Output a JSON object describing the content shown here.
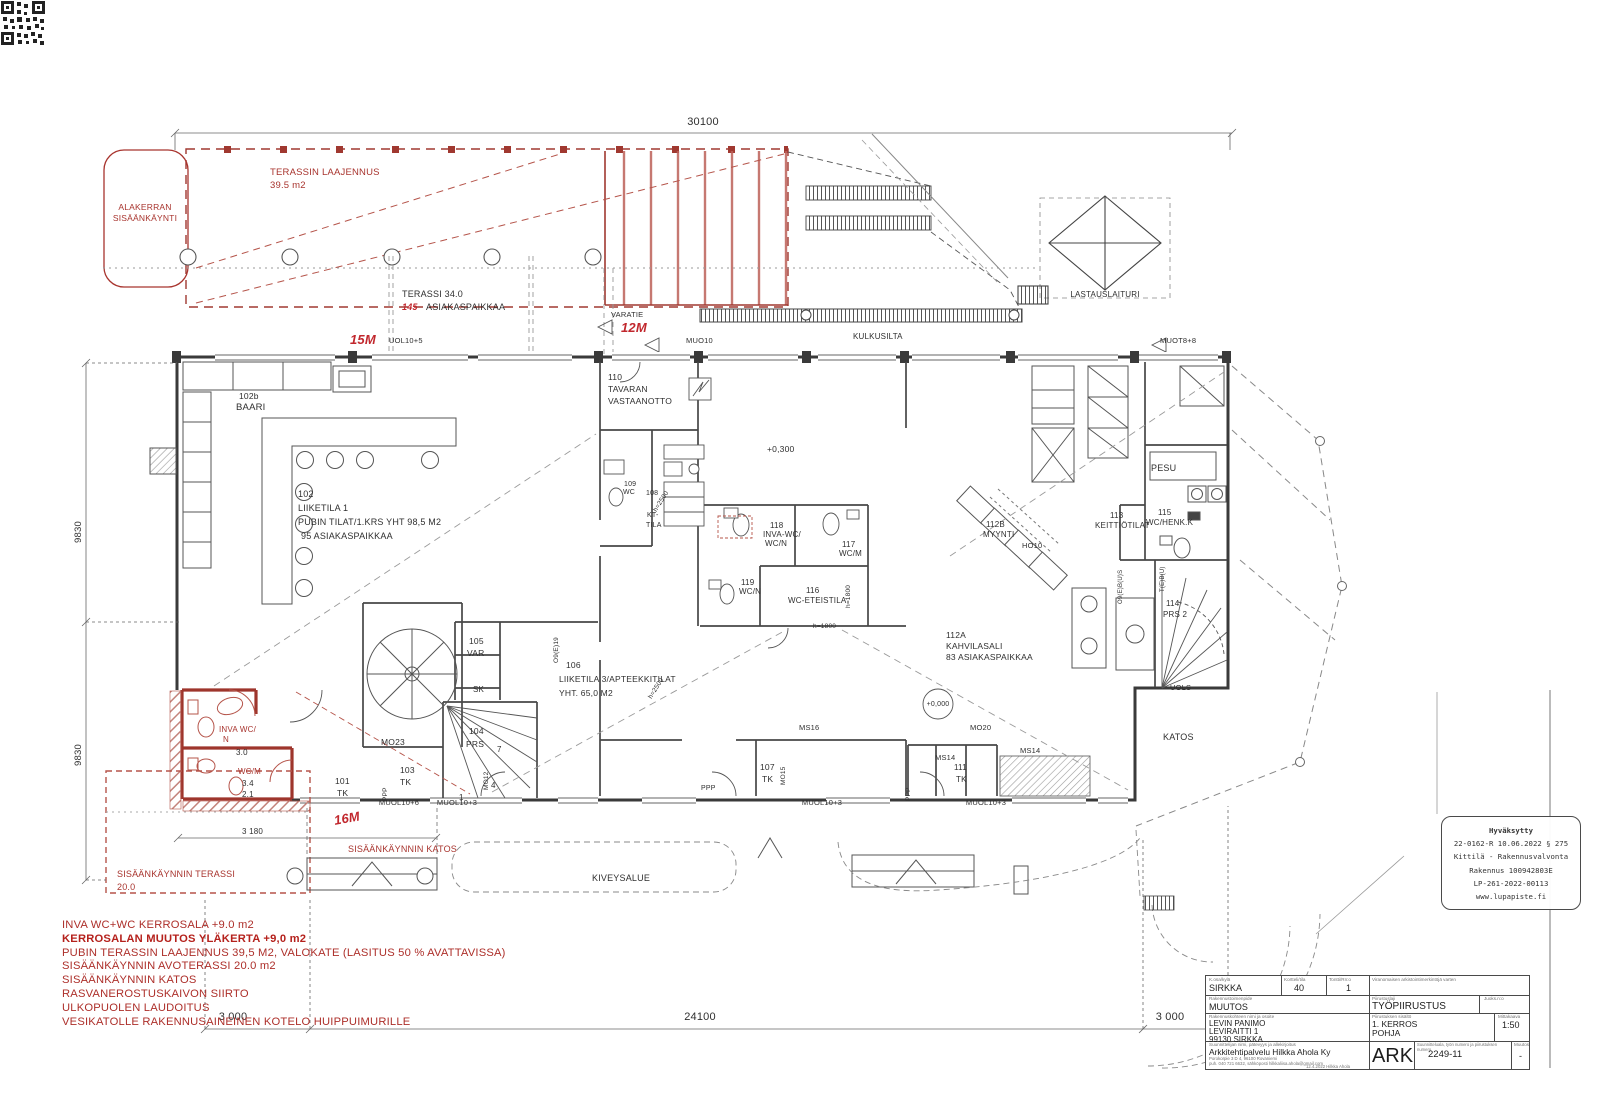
{
  "drawing": {
    "type": "architectural-floor-plan",
    "accent_red": "#a8342e",
    "ink": "#3a3a3a"
  },
  "labels": [
    {
      "t": "30100",
      "x": 703,
      "y": 117,
      "s": 11,
      "m": 1
    },
    {
      "t": "TERASSIN LAAJENNUS",
      "x": 270,
      "y": 168,
      "c": "r",
      "s": 9.5
    },
    {
      "t": "39.5 m2",
      "x": 270,
      "y": 181,
      "c": "r",
      "s": 9.5
    },
    {
      "t": "ALAKERRAN",
      "x": 145,
      "y": 203,
      "c": "r",
      "s": 8.5,
      "m": 1
    },
    {
      "t": "SISÄÄNKÄYNTI",
      "x": 145,
      "y": 214,
      "c": "r",
      "s": 8.5,
      "m": 1
    },
    {
      "t": "TERASSI 34.0",
      "x": 402,
      "y": 290,
      "s": 9
    },
    {
      "t": "145",
      "x": 402,
      "y": 303,
      "c": "rb",
      "s": 9
    },
    {
      "t": "ASIAKASPAIKKAA",
      "x": 426,
      "y": 303,
      "s": 9
    },
    {
      "t": "15M",
      "x": 350,
      "y": 333,
      "c": "rb",
      "s": 13
    },
    {
      "t": "UOL10+5",
      "x": 389,
      "y": 337,
      "s": 7.5
    },
    {
      "t": "VARATIE",
      "x": 611,
      "y": 311,
      "s": 7.5
    },
    {
      "t": "12M",
      "x": 621,
      "y": 321,
      "c": "rb",
      "s": 13
    },
    {
      "t": "MUO10",
      "x": 686,
      "y": 337,
      "s": 7.5
    },
    {
      "t": "KULKUSILTA",
      "x": 853,
      "y": 333,
      "s": 8
    },
    {
      "t": "MUOT8+8",
      "x": 1160,
      "y": 337,
      "s": 7.5
    },
    {
      "t": "LASTAUSLAITURI",
      "x": 1105,
      "y": 291,
      "s": 8,
      "m": 1
    },
    {
      "t": "102b",
      "x": 239,
      "y": 392,
      "s": 8.5
    },
    {
      "t": "BAARI",
      "x": 236,
      "y": 403,
      "s": 9.5
    },
    {
      "t": "110",
      "x": 608,
      "y": 373,
      "s": 8.5
    },
    {
      "t": "TAVARAN",
      "x": 608,
      "y": 385,
      "s": 8.5
    },
    {
      "t": "VASTAANOTTO",
      "x": 608,
      "y": 397,
      "s": 8.5
    },
    {
      "t": "102",
      "x": 298,
      "y": 490,
      "s": 9
    },
    {
      "t": "LIIKETILA 1",
      "x": 298,
      "y": 504,
      "s": 9
    },
    {
      "t": "PUBIN TILAT/1.KRS YHT 98,5 M2",
      "x": 298,
      "y": 518,
      "s": 9
    },
    {
      "t": "95 ASIAKASPAIKKAA",
      "x": 301,
      "y": 532,
      "s": 9
    },
    {
      "t": "109",
      "x": 624,
      "y": 481,
      "s": 7
    },
    {
      "t": "WC",
      "x": 623,
      "y": 489,
      "s": 7
    },
    {
      "t": "108",
      "x": 646,
      "y": 490,
      "s": 7
    },
    {
      "t": "KT-",
      "x": 647,
      "y": 512,
      "s": 7
    },
    {
      "t": "TILA",
      "x": 646,
      "y": 522,
      "s": 7
    },
    {
      "t": "h=2500",
      "x": 653,
      "y": 510,
      "s": 6.5,
      "r": -58
    },
    {
      "t": "+0,300",
      "x": 767,
      "y": 445,
      "s": 8.5
    },
    {
      "t": "118",
      "x": 770,
      "y": 522,
      "s": 8
    },
    {
      "t": "INVA-WC/",
      "x": 763,
      "y": 531,
      "s": 8
    },
    {
      "t": "WC/N",
      "x": 765,
      "y": 540,
      "s": 8
    },
    {
      "t": "117",
      "x": 842,
      "y": 541,
      "s": 8
    },
    {
      "t": "WC/M",
      "x": 839,
      "y": 550,
      "s": 8
    },
    {
      "t": "119",
      "x": 741,
      "y": 579,
      "s": 8
    },
    {
      "t": "WC/N",
      "x": 739,
      "y": 588,
      "s": 8
    },
    {
      "t": "116",
      "x": 806,
      "y": 587,
      "s": 8
    },
    {
      "t": "WC-ETEISTILA",
      "x": 788,
      "y": 597,
      "s": 8
    },
    {
      "t": "112B",
      "x": 986,
      "y": 521,
      "s": 8
    },
    {
      "t": "MYYNTI",
      "x": 983,
      "y": 531,
      "s": 8
    },
    {
      "t": "113",
      "x": 1110,
      "y": 512,
      "s": 8
    },
    {
      "t": "KEITTIÖTILAT",
      "x": 1095,
      "y": 522,
      "s": 8
    },
    {
      "t": "PESU",
      "x": 1151,
      "y": 464,
      "s": 9
    },
    {
      "t": "115",
      "x": 1158,
      "y": 509,
      "s": 8
    },
    {
      "t": "WC/HENK.K",
      "x": 1146,
      "y": 519,
      "s": 8
    },
    {
      "t": "HO10",
      "x": 1022,
      "y": 542,
      "s": 7.5
    },
    {
      "t": "112A",
      "x": 946,
      "y": 631,
      "s": 8.5
    },
    {
      "t": "KAHVILASALI",
      "x": 946,
      "y": 642,
      "s": 8.5
    },
    {
      "t": "83 ASIAKASPAIKKAA",
      "x": 946,
      "y": 653,
      "s": 8.5
    },
    {
      "t": "+0,000",
      "x": 938,
      "y": 701,
      "s": 7,
      "m": 1
    },
    {
      "t": "106",
      "x": 566,
      "y": 661,
      "s": 8.5
    },
    {
      "t": "LIIKETILA 3/APTEEKKITILAT",
      "x": 559,
      "y": 675,
      "s": 8.5
    },
    {
      "t": "YHT. 65,0 M2",
      "x": 559,
      "y": 689,
      "s": 8.5
    },
    {
      "t": "105",
      "x": 469,
      "y": 637,
      "s": 8.5
    },
    {
      "t": "VAR",
      "x": 467,
      "y": 649,
      "s": 8.5
    },
    {
      "t": "SK",
      "x": 473,
      "y": 686,
      "s": 8
    },
    {
      "t": "104",
      "x": 469,
      "y": 727,
      "s": 8.5
    },
    {
      "t": "PRS",
      "x": 466,
      "y": 740,
      "s": 8.5
    },
    {
      "t": "7",
      "x": 497,
      "y": 746,
      "s": 8
    },
    {
      "t": "4",
      "x": 491,
      "y": 782,
      "s": 8
    },
    {
      "t": "1",
      "x": 459,
      "y": 794,
      "s": 8
    },
    {
      "t": "MO12",
      "x": 484,
      "y": 790,
      "s": 6.5,
      "r": -90
    },
    {
      "t": "MO23",
      "x": 381,
      "y": 738,
      "s": 8.5
    },
    {
      "t": "103",
      "x": 400,
      "y": 766,
      "s": 8.5
    },
    {
      "t": "TK",
      "x": 400,
      "y": 778,
      "s": 8.5
    },
    {
      "t": "101",
      "x": 335,
      "y": 777,
      "s": 8.5
    },
    {
      "t": "TK",
      "x": 337,
      "y": 789,
      "s": 8.5
    },
    {
      "t": "PPP",
      "x": 383,
      "y": 801,
      "s": 6.5,
      "r": -90
    },
    {
      "t": "O9(E)19",
      "x": 554,
      "y": 663,
      "s": 6.5,
      "r": -90
    },
    {
      "t": "h=1800",
      "x": 846,
      "y": 608,
      "s": 6.5,
      "r": -90
    },
    {
      "t": "h=1800",
      "x": 813,
      "y": 624,
      "s": 6.5
    },
    {
      "t": "h=2500",
      "x": 648,
      "y": 697,
      "s": 6.5,
      "r": -58
    },
    {
      "t": "MS16",
      "x": 799,
      "y": 724,
      "s": 7.5
    },
    {
      "t": "MO15",
      "x": 781,
      "y": 785,
      "s": 6.5,
      "r": -90
    },
    {
      "t": "107",
      "x": 760,
      "y": 763,
      "s": 8.5
    },
    {
      "t": "TK",
      "x": 762,
      "y": 775,
      "s": 8.5
    },
    {
      "t": "PPP",
      "x": 701,
      "y": 785,
      "s": 7
    },
    {
      "t": "PPP",
      "x": 906,
      "y": 801,
      "s": 6.5,
      "r": -90
    },
    {
      "t": "MO20",
      "x": 970,
      "y": 724,
      "s": 7.5
    },
    {
      "t": "MS14",
      "x": 935,
      "y": 754,
      "s": 7.5
    },
    {
      "t": "111",
      "x": 954,
      "y": 764,
      "s": 8
    },
    {
      "t": "TK",
      "x": 956,
      "y": 776,
      "s": 8
    },
    {
      "t": "MS14",
      "x": 1020,
      "y": 747,
      "s": 7.5
    },
    {
      "t": "114",
      "x": 1166,
      "y": 600,
      "s": 8
    },
    {
      "t": "PRS 2",
      "x": 1163,
      "y": 611,
      "s": 8
    },
    {
      "t": "O9(E)B(U)S",
      "x": 1118,
      "y": 604,
      "s": 6,
      "r": -90
    },
    {
      "t": "T(E)B(U)",
      "x": 1160,
      "y": 592,
      "s": 6,
      "r": -90
    },
    {
      "t": "UOLS",
      "x": 1170,
      "y": 684,
      "s": 7.5
    },
    {
      "t": "KATOS",
      "x": 1163,
      "y": 733,
      "s": 9
    },
    {
      "t": "INVA WC/",
      "x": 219,
      "y": 726,
      "c": "r",
      "s": 8
    },
    {
      "t": "N",
      "x": 223,
      "y": 736,
      "c": "r",
      "s": 8
    },
    {
      "t": "3.0",
      "x": 236,
      "y": 749,
      "s": 8
    },
    {
      "t": "WC/M",
      "x": 238,
      "y": 768,
      "c": "r",
      "s": 8
    },
    {
      "t": "3.4",
      "x": 242,
      "y": 780,
      "s": 8
    },
    {
      "t": "2.1",
      "x": 242,
      "y": 791,
      "s": 8
    },
    {
      "t": "16M",
      "x": 333,
      "y": 814,
      "c": "rb",
      "s": 13,
      "r": -10
    },
    {
      "t": "MUOL10+6",
      "x": 399,
      "y": 799,
      "s": 7.5,
      "m": 1
    },
    {
      "t": "MUOL10+3",
      "x": 457,
      "y": 799,
      "s": 7.5,
      "m": 1
    },
    {
      "t": "MUOL10+3",
      "x": 822,
      "y": 799,
      "s": 7.5,
      "m": 1
    },
    {
      "t": "MUOL10+3",
      "x": 986,
      "y": 799,
      "s": 7.5,
      "m": 1
    },
    {
      "t": "SISÄÄNKÄYNNIN KATOS",
      "x": 348,
      "y": 845,
      "c": "r",
      "s": 9
    },
    {
      "t": "3 180",
      "x": 242,
      "y": 828,
      "s": 8
    },
    {
      "t": "SISÄÄNKÄYNNIN TERASSI",
      "x": 117,
      "y": 870,
      "c": "r",
      "s": 9
    },
    {
      "t": "20.0",
      "x": 117,
      "y": 883,
      "c": "r",
      "s": 9
    },
    {
      "t": "KIVEYSALUE",
      "x": 592,
      "y": 874,
      "s": 9
    },
    {
      "t": "9830",
      "x": 74,
      "y": 543,
      "s": 9.5,
      "r": -90
    },
    {
      "t": "9830",
      "x": 74,
      "y": 766,
      "s": 9.5,
      "r": -90
    },
    {
      "t": "3 000",
      "x": 233,
      "y": 1012,
      "s": 11,
      "m": 1
    },
    {
      "t": "24100",
      "x": 700,
      "y": 1012,
      "s": 11,
      "m": 1
    },
    {
      "t": "3 000",
      "x": 1170,
      "y": 1012,
      "s": 11,
      "m": 1
    }
  ],
  "notes": {
    "lines": [
      {
        "t": "INVA WC+WC KERROSALA +9.0 m2"
      },
      {
        "t": "KERROSALAN MUUTOS YLÄKERTA +9,0 m2",
        "b": 1
      },
      {
        "t": "PUBIN TERASSIN LAAJENNUS 39,5 M2, VALOKATE (LASITUS 50 % AVATTAVISSA)"
      },
      {
        "t": "SISÄÄNKÄYNNIN AVOTERASSI 20.0 m2"
      },
      {
        "t": "SISÄÄNKÄYNNIN KATOS"
      },
      {
        "t": "RASVANEROSTUSKAIVON SIIRTO"
      },
      {
        "t": "ULKOPUOLEN LAUDOITUS"
      },
      {
        "t": "VESIKATOLLE RAKENNUSAINEINEN KOTELO HUIPPUIMURILLE"
      }
    ]
  },
  "stamp": {
    "lines": [
      "Hyväksytty",
      "22-0162-R 10.06.2022 § 275",
      "Kittilä - Rakennusvalvonta",
      "Rakennus 100942803E",
      "LP-261-2022-00113",
      "www.lupapiste.fi"
    ]
  },
  "title_block": {
    "r1c1_label": "K.osa/kylä",
    "r1c1": "SIRKKA",
    "r1c2_label": "Kortteli/tila",
    "r1c2": "40",
    "r1c3_label": "Tontti/Rn:o",
    "r1c3": "1",
    "r1r_label": "Viranomaisen arkistointimerkintöjä varten",
    "r2l_label": "Rakennustoimenpide",
    "r2l": "MUUTOS",
    "r2r_label": "Piirustuslaji",
    "r2r": "TYÖPIIRUSTUS",
    "r2r2_label": "Juoks.n:o",
    "r3l_label": "Rakennuskohteen nimi ja osoite",
    "addr1": "LEVIN PANIMO",
    "addr2": "LEVIRAITTI 1",
    "addr3": "99130 SIRKKA",
    "r3r_label": "Piirustuksen sisältö",
    "content1": "1. KERROS",
    "content2": "POHJA",
    "scale_label": "Mittakaava",
    "scale": "1:50",
    "r4l_label": "Suunnittelijan nimi, pätevyys ja allekirjoitus",
    "designer": "Arkkitehtipalvelu Hilkka Ahola Ky",
    "designer_addr": "Porokorpie 3 D 4, 96100 Rovaniemi",
    "designer_tel": "puh. 040 721 6632, sähköposti hilkkaliisa.ahola@gmail.com",
    "signed": "12.4.2022  Hilkka Ahola",
    "r4r_label": "Suunnitteluala, työn numero ja piirustuksen numero",
    "discipline": "ARK",
    "number": "2249-11",
    "rev_label": "Muutos",
    "rev": "-"
  }
}
